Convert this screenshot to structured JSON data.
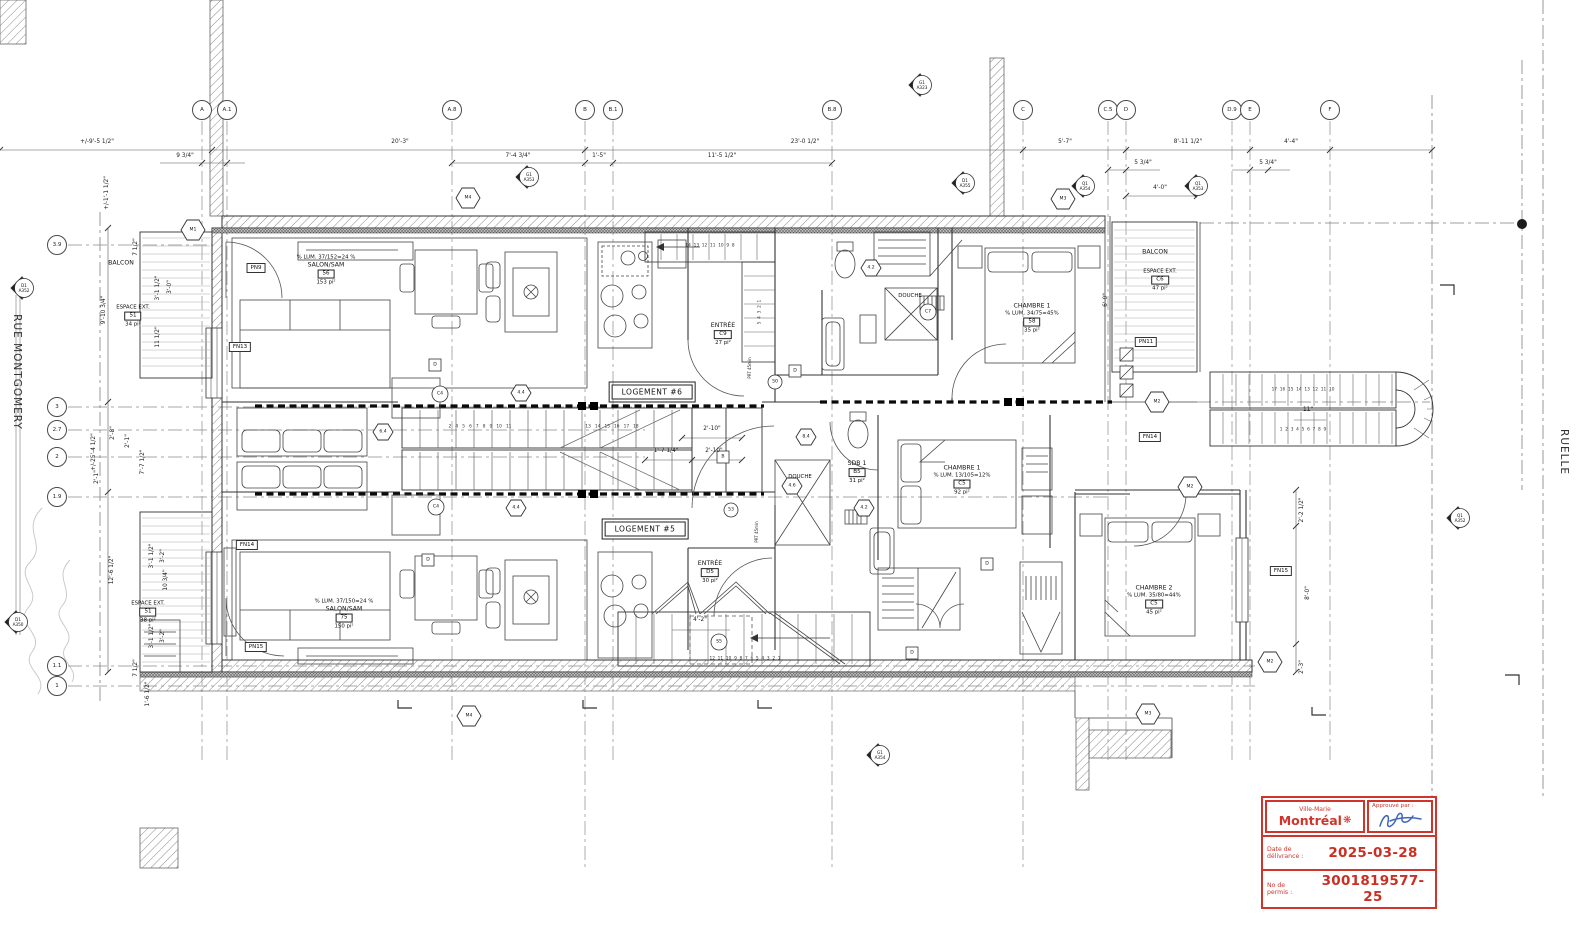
{
  "streets": {
    "left": "RUE MONTGOMERY",
    "right": "RUELLE"
  },
  "grid_top": [
    {
      "label": "A"
    },
    {
      "label": "A.1"
    },
    {
      "label": "A.8"
    },
    {
      "label": "B"
    },
    {
      "label": "B.1"
    },
    {
      "label": "B.8"
    },
    {
      "label": "C"
    },
    {
      "label": "C.5"
    },
    {
      "label": "D"
    },
    {
      "label": "D.9"
    },
    {
      "label": "E"
    },
    {
      "label": "F"
    }
  ],
  "grid_left": [
    {
      "label": "3.9"
    },
    {
      "label": "3"
    },
    {
      "label": "2.7"
    },
    {
      "label": "2"
    },
    {
      "label": "1.9"
    },
    {
      "label": "1.1"
    },
    {
      "label": "1"
    }
  ],
  "units": {
    "u6": "LOGEMENT #6",
    "u5": "LOGEMENT #5"
  },
  "rooms": {
    "salon6": {
      "lum": "% LUM. 37/152=24 %",
      "name": "SALON/SAM",
      "num": "56",
      "area": "153 pi²"
    },
    "entree6": {
      "name": "ENTRÉE",
      "num": "C9",
      "area": "27 pi²"
    },
    "chambre1_6": {
      "name": "CHAMBRE 1",
      "lum": "% LUM. 34/75=45%",
      "num": "58",
      "area": "35 pi²"
    },
    "douche6": {
      "name": "DOUCHE"
    },
    "sdb1": {
      "name": "SDB 1",
      "num": "B5",
      "area": "31 pi²"
    },
    "douche5": {
      "name": "DOUCHE"
    },
    "chambre1_5": {
      "name": "CHAMBRE 1",
      "lum": "% LUM. 13/105=12%",
      "num": "C5",
      "area": "92 pi²"
    },
    "salon5": {
      "lum": "% LUM. 37/150=24 %",
      "name": "SALON/SAM",
      "num": "75",
      "area": "150 pi²"
    },
    "entree5": {
      "name": "ENTRÉE",
      "num": "D5",
      "area": "30 pi²"
    },
    "chambre2": {
      "name": "CHAMBRE 2",
      "lum": "% LUM. 35/80=44%",
      "num": "C5",
      "area": "45 pi²"
    },
    "balcon_tl": {
      "name": "BALCON"
    },
    "balcon_tr": {
      "name": "BALCON"
    },
    "espace_tl": {
      "name": "ESPACE EXT.",
      "num": "51",
      "area": "34 pi²"
    },
    "espace_tr": {
      "name": "ESPACE EXT.",
      "num": "C6",
      "area": "47 pi²"
    },
    "espace_bl": {
      "name": "ESPACE EXT.",
      "num": "51",
      "area": "38 pi²"
    }
  },
  "tags": {
    "pn9": "PN9",
    "fn13": "FN13",
    "pn11": "PN11",
    "fn14r": "FN14",
    "fn15": "FN15",
    "fn14l": "FN14",
    "pn15": "PN15",
    "prt": "PRT 45min"
  },
  "hex": {
    "m1": "M1",
    "m2": "M2",
    "m3": "M3",
    "m4": "M4",
    "h44": "4.4",
    "h64": "6.4",
    "h84": "8.4",
    "h42": "4.2",
    "h46": "4.6"
  },
  "circles": {
    "c4": "C4",
    "s5": "S5",
    "c7": "C7",
    "d50": "50",
    "d53": "53"
  },
  "boxes": {
    "d": "D",
    "b": "B"
  },
  "sections": {
    "tl": {
      "a": "G1",
      "b": "A353"
    },
    "tc": {
      "a": "G1",
      "b": "A323"
    },
    "mid": {
      "a": "D1",
      "b": "A355"
    },
    "tr1": {
      "a": "Q1",
      "b": "A354"
    },
    "tr2": {
      "a": "Q1",
      "b": "A353"
    },
    "l1": {
      "a": "D1",
      "b": "A352"
    },
    "l2": {
      "a": "D1",
      "b": "A350"
    },
    "r1": {
      "a": "Q1",
      "b": "A352"
    },
    "b1": {
      "a": "G1",
      "b": "A354"
    }
  },
  "dims": {
    "d1": "+/-9'-5 1/2\"",
    "d2": "20'-3\"",
    "d3": "23'-0 1/2\"",
    "d4": "5'-7\"",
    "d5": "8'-11 1/2\"",
    "d6": "4'-4\"",
    "d7": "9 3/4\"",
    "d8": "7'-4 3/4\"",
    "d9": "1'-5\"",
    "d10": "11'-5 1/2\"",
    "d11": "5 3/4\"",
    "d12": "5 3/4\"",
    "d13": "4'-0\"",
    "d14": "+/-1'-1 1/2\"",
    "d15": "9'-10 3/4\"",
    "d16": "12'-6 1/2\"",
    "d17": "+/-25'-4 1/2\"",
    "d18": "2'-8\"",
    "d19": "2'-1\"",
    "d20": "7'-7 1/2\"",
    "d21": "2'-1\"",
    "d22": "7 1/2\"",
    "d23": "3'-1 1/2\"",
    "d24": "3'-0\"",
    "d25": "11 1/2\"",
    "d27": "10 3/4\"",
    "d28": "3'-1 1/2\"",
    "d29": "3'-2\"",
    "d30": "3'-1 1/2\"",
    "d31": "3'-2\"",
    "d32": "7 1/2\"",
    "d33": "1'-6 1/2\"",
    "d34": "2'-10\"",
    "d35": "1'-7 1/4\"",
    "d36": "2'-10\"",
    "d37": "4'-2\"",
    "d38": "11\"",
    "d39": "2'-2 1/2\"",
    "d40": "8'-0\"",
    "d41": "2'-3\"",
    "d42": "6'-0\""
  },
  "stair_numbers": {
    "central_a": "2   4   5   6   7   8   9   10   11",
    "central_b": "13   14   15   16   17   18",
    "entry6_top": "14  13  12  11  10  9  8",
    "entry6_side": "5  4  3  2  1",
    "stair5": "12  11  10  9  8  7  6  5  4  3  2  1",
    "ext_top": "17  16  15  14  13  12  11  10",
    "ext_bot": "1  2  3  4  5  6  7  8  9"
  },
  "stamp": {
    "borough": "Ville-Marie",
    "city": "Montréal",
    "flower_icon": "❋",
    "approved_label": "Approuvé par :",
    "date_label_1": "Date de",
    "date_label_2": "délivrance :",
    "date_value": "2025-03-28",
    "permit_label_1": "No de",
    "permit_label_2": "permis :",
    "permit_value": "3001819577-25",
    "red": "#cf352a",
    "signature_blue": "#4066b8"
  }
}
